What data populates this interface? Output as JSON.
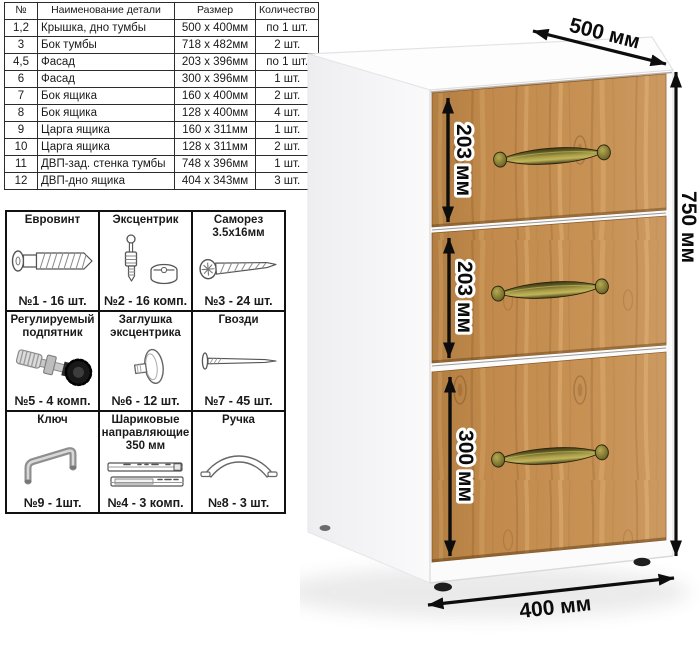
{
  "parts_table": {
    "headers": [
      "№",
      "Наименование детали",
      "Размер",
      "Количество"
    ],
    "rows": [
      [
        "1,2",
        "Крышка, дно тумбы",
        "500 х 400мм",
        "по 1 шт."
      ],
      [
        "3",
        "Бок тумбы",
        "718 х 482мм",
        "2 шт."
      ],
      [
        "4,5",
        "Фасад",
        "203 х 396мм",
        "по 1 шт."
      ],
      [
        "6",
        "Фасад",
        "300 х 396мм",
        "1 шт."
      ],
      [
        "7",
        "Бок ящика",
        "160 х 400мм",
        "2 шт."
      ],
      [
        "8",
        "Бок ящика",
        "128 х 400мм",
        "4 шт."
      ],
      [
        "9",
        "Царга ящика",
        "160 х 311мм",
        "1 шт."
      ],
      [
        "10",
        "Царга ящика",
        "128 х 311мм",
        "2 шт."
      ],
      [
        "11",
        "ДВП-зад. стенка тумбы",
        "748 х 396мм",
        "1 шт."
      ],
      [
        "12",
        "ДВП-дно ящика",
        "404 х 343мм",
        "3 шт."
      ]
    ]
  },
  "hardware": {
    "items": [
      {
        "title": "Евровинт",
        "count": "№1 - 16 шт.",
        "icon": "euro-screw-icon"
      },
      {
        "title": "Эксцентрик",
        "count": "№2 - 16 комп.",
        "icon": "eccentric-cam-icon"
      },
      {
        "title": "Саморез 3.5х16мм",
        "count": "№3 - 24 шт.",
        "icon": "self-tapping-screw-icon"
      },
      {
        "title": "Регулируемый подпятник",
        "count": "№5 - 4 комп.",
        "icon": "adjustable-foot-icon"
      },
      {
        "title": "Заглушка эксцентрика",
        "count": "№6 - 12 шт.",
        "icon": "cam-cover-icon"
      },
      {
        "title": "Гвозди",
        "count": "№7 - 45 шт.",
        "icon": "nail-icon"
      },
      {
        "title": "Ключ",
        "count": "№9 - 1шт.",
        "icon": "hex-key-icon"
      },
      {
        "title": "Шариковые направляющие 350 мм",
        "count": "№4 - 3 комп.",
        "icon": "ball-slides-icon"
      },
      {
        "title": "Ручка",
        "count": "№8 - 3 шт.",
        "icon": "bow-handle-icon"
      }
    ]
  },
  "cabinet": {
    "dimension_labels": {
      "depth": "500 мм",
      "height": "750 мм",
      "width": "400 мм",
      "drawer_heights": [
        "203 мм",
        "203 мм",
        "300 мм"
      ]
    },
    "colors": {
      "wood": "#c68e4f",
      "body_white": "#fbfbfc",
      "handle_brass": "#8a8136",
      "dimension_black": "#0d0d0d"
    }
  }
}
